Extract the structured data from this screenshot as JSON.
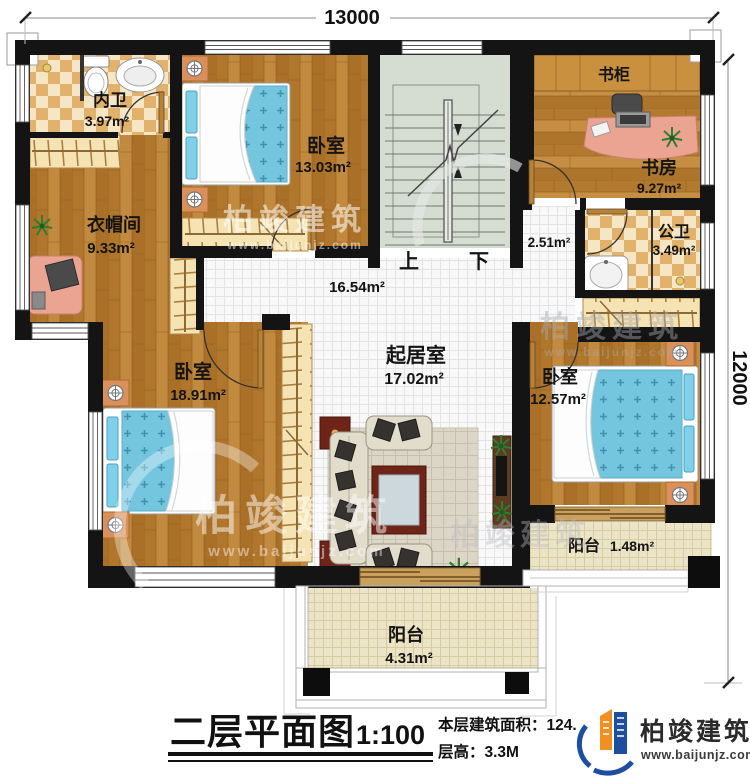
{
  "dimensions": {
    "top": "13000",
    "right": "12000"
  },
  "stairs": {
    "up": "上",
    "down": "下"
  },
  "rooms": {
    "inner_bath": {
      "name": "内卫",
      "area": "3.97m²"
    },
    "bedroom_top": {
      "name": "卧室",
      "area": "13.03m²"
    },
    "bookcase": {
      "name": "书柜"
    },
    "study": {
      "name": "书房",
      "area": "9.27m²"
    },
    "public_bath": {
      "name": "公卫",
      "area": "3.49m²"
    },
    "hall_small": {
      "area": "2.51m²"
    },
    "cloakroom": {
      "name": "衣帽间",
      "area": "9.33m²"
    },
    "hallway": {
      "area": "16.54m²"
    },
    "bedroom_left": {
      "name": "卧室",
      "area": "18.91m²"
    },
    "living": {
      "name": "起居室",
      "area": "17.02m²"
    },
    "bedroom_right": {
      "name": "卧室",
      "area": "12.57m²"
    },
    "balcony_right": {
      "name": "阳台",
      "area": "1.48m²"
    },
    "balcony_bottom": {
      "name": "阳台",
      "area": "4.31m²"
    }
  },
  "titleblock": {
    "title": "二层平面图",
    "scale": "1:100",
    "area_label": "本层建筑面积：124.",
    "floor_height": "层高：3.3M"
  },
  "brand": {
    "name": "柏竣建筑",
    "url": "www.baijunjz.com"
  },
  "watermark": {
    "name": "柏竣建筑",
    "url": "www.baijunjz.com"
  },
  "colors": {
    "wall": "#141414",
    "wood": "#b87c30",
    "checker_tan": "#e2b26c",
    "bed_blue": "#74c6df",
    "stair": "#d5dcd1",
    "balcony_tile": "#ece4c6",
    "logo_blue": "#1d4f9e",
    "logo_orange": "#f09022"
  }
}
